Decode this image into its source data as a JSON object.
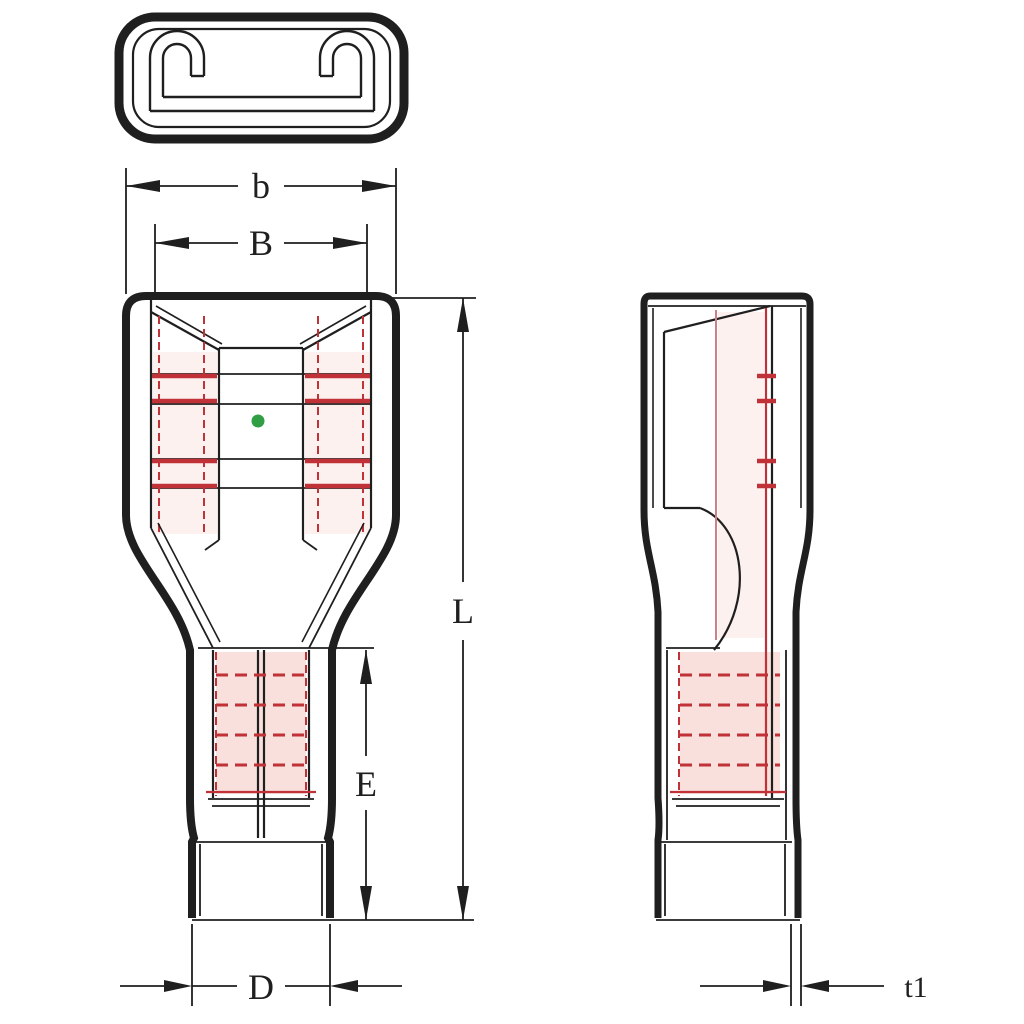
{
  "dimension_labels": {
    "b": "b",
    "B": "B",
    "L": "L",
    "E": "E",
    "D": "D",
    "t1": "t1"
  },
  "colors": {
    "ink": "#1f1f1f",
    "red": "#c03238",
    "pink-line": "#cf8086",
    "pink-fill": "#f9e0dc",
    "pink-faint": "#fdf1f0",
    "green": "#2f9e44",
    "background": "#ffffff"
  }
}
